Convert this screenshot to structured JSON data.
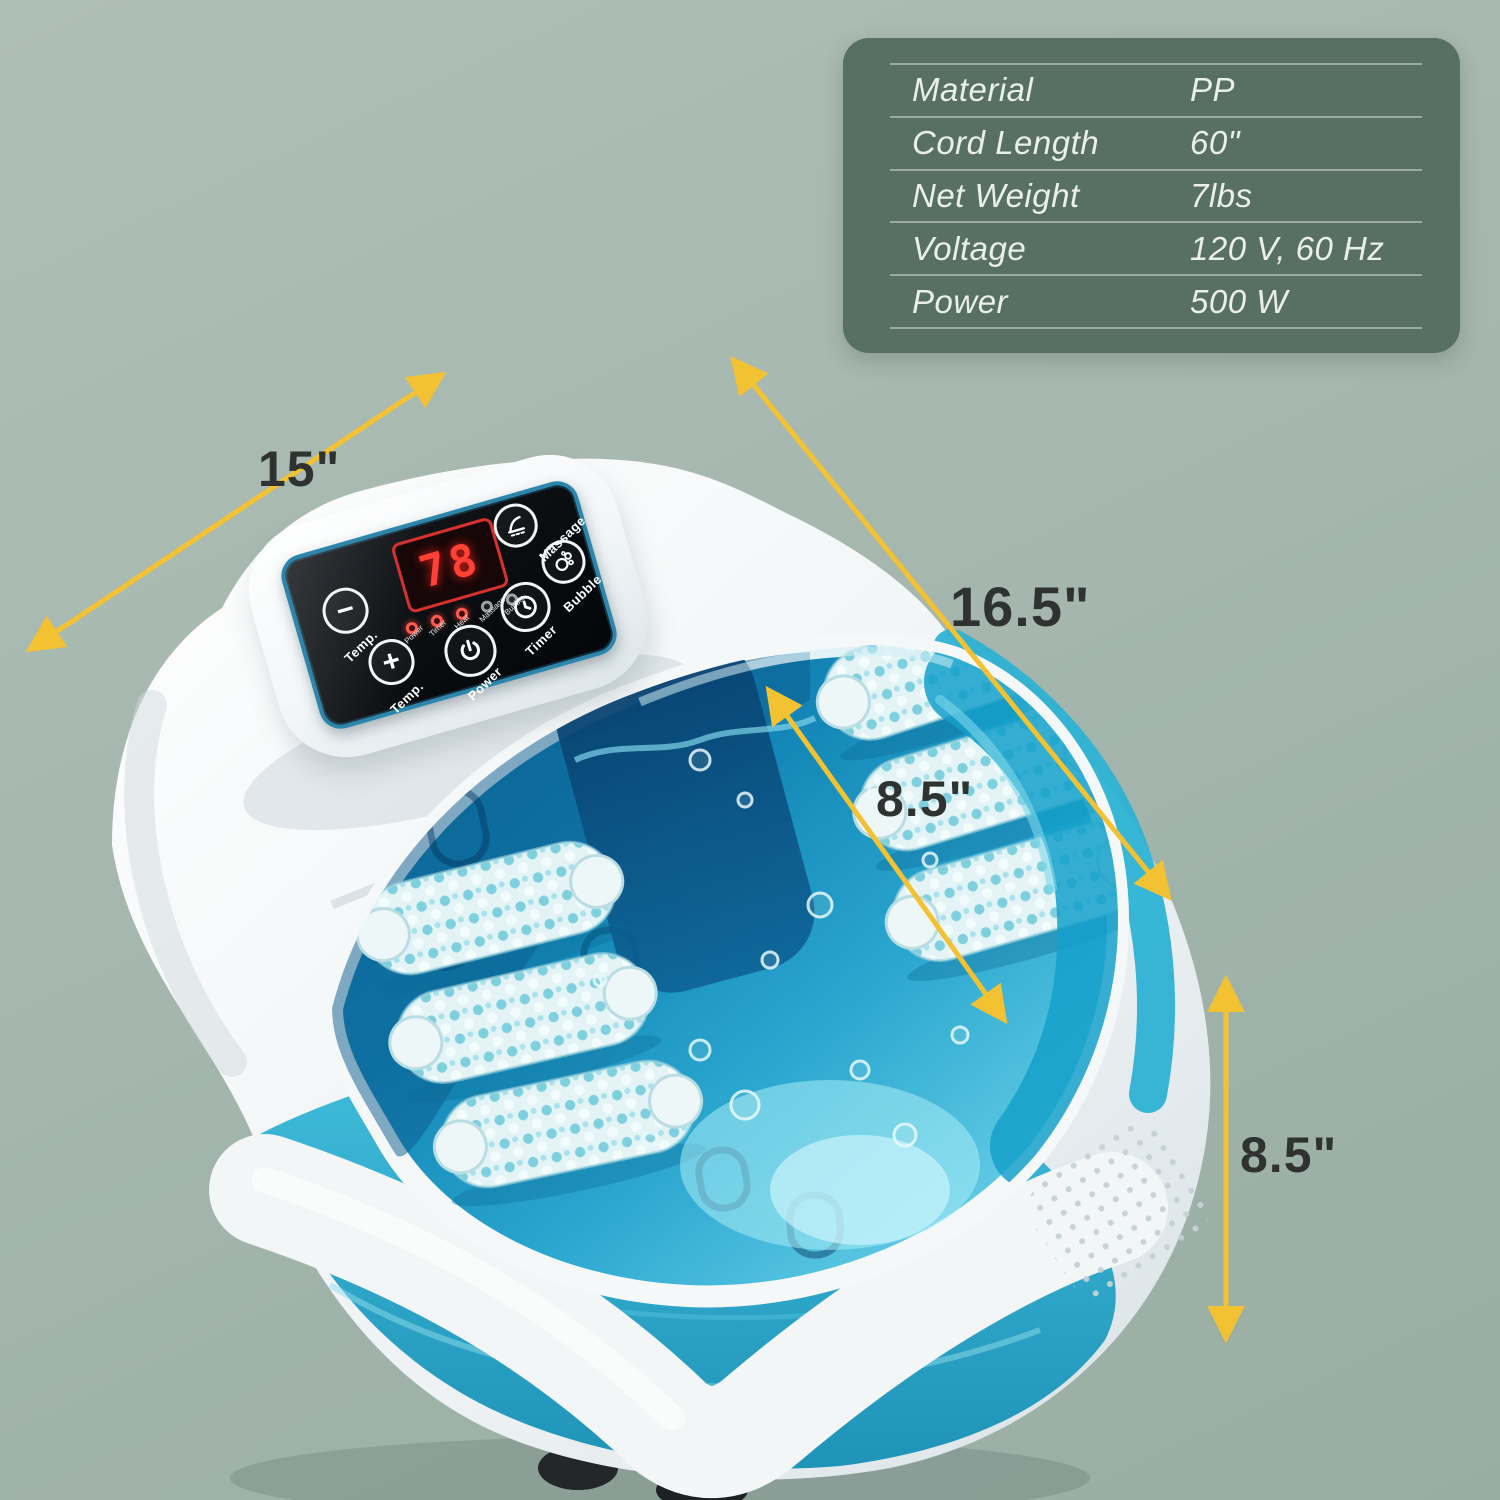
{
  "page": {
    "type": "product-infographic",
    "subject": "foot spa bath massager"
  },
  "spec_table": {
    "bg_color": "#586f66",
    "text_color": "#e9efeb",
    "rows": [
      {
        "label": "Material",
        "value": "PP"
      },
      {
        "label": "Cord Length",
        "value": "60\""
      },
      {
        "label": "Net Weight",
        "value": "7lbs"
      },
      {
        "label": "Voltage",
        "value": "120 V, 60 Hz"
      },
      {
        "label": "Power",
        "value": "500 W"
      }
    ]
  },
  "dimensions": {
    "arrow_color": "#f2c233",
    "text_color": "#2e3331",
    "width_label": "15\"",
    "diagonal_label": "16.5\"",
    "inner_depth_label": "8.5\"",
    "height_label": "8.5\""
  },
  "control_panel": {
    "display_value": "78",
    "display_color": "#ff4136",
    "panel_border_color": "#2c86ab",
    "buttons": {
      "temp_minus": {
        "label": "Temp.",
        "icon": "minus-icon"
      },
      "temp_plus": {
        "label": "Temp.",
        "icon": "plus-icon"
      },
      "power": {
        "label": "Power",
        "icon": "power-icon"
      },
      "timer": {
        "label": "Timer",
        "icon": "clock-icon"
      },
      "massage": {
        "label": "Massage",
        "icon": "foot-massage-icon"
      },
      "bubble": {
        "label": "Bubble",
        "icon": "bubbles-icon"
      }
    },
    "indicators": [
      "Power",
      "Timer",
      "Heat",
      "Massage",
      "Bubble"
    ]
  },
  "product_colors": {
    "shell_white": "#f2f5f6",
    "tub_lip_teal": "#2eb2d4",
    "water_deep_navy": "#0a5a8c",
    "water_light_cyan": "#8fdff0",
    "body_teal": "#2aa7c9"
  }
}
